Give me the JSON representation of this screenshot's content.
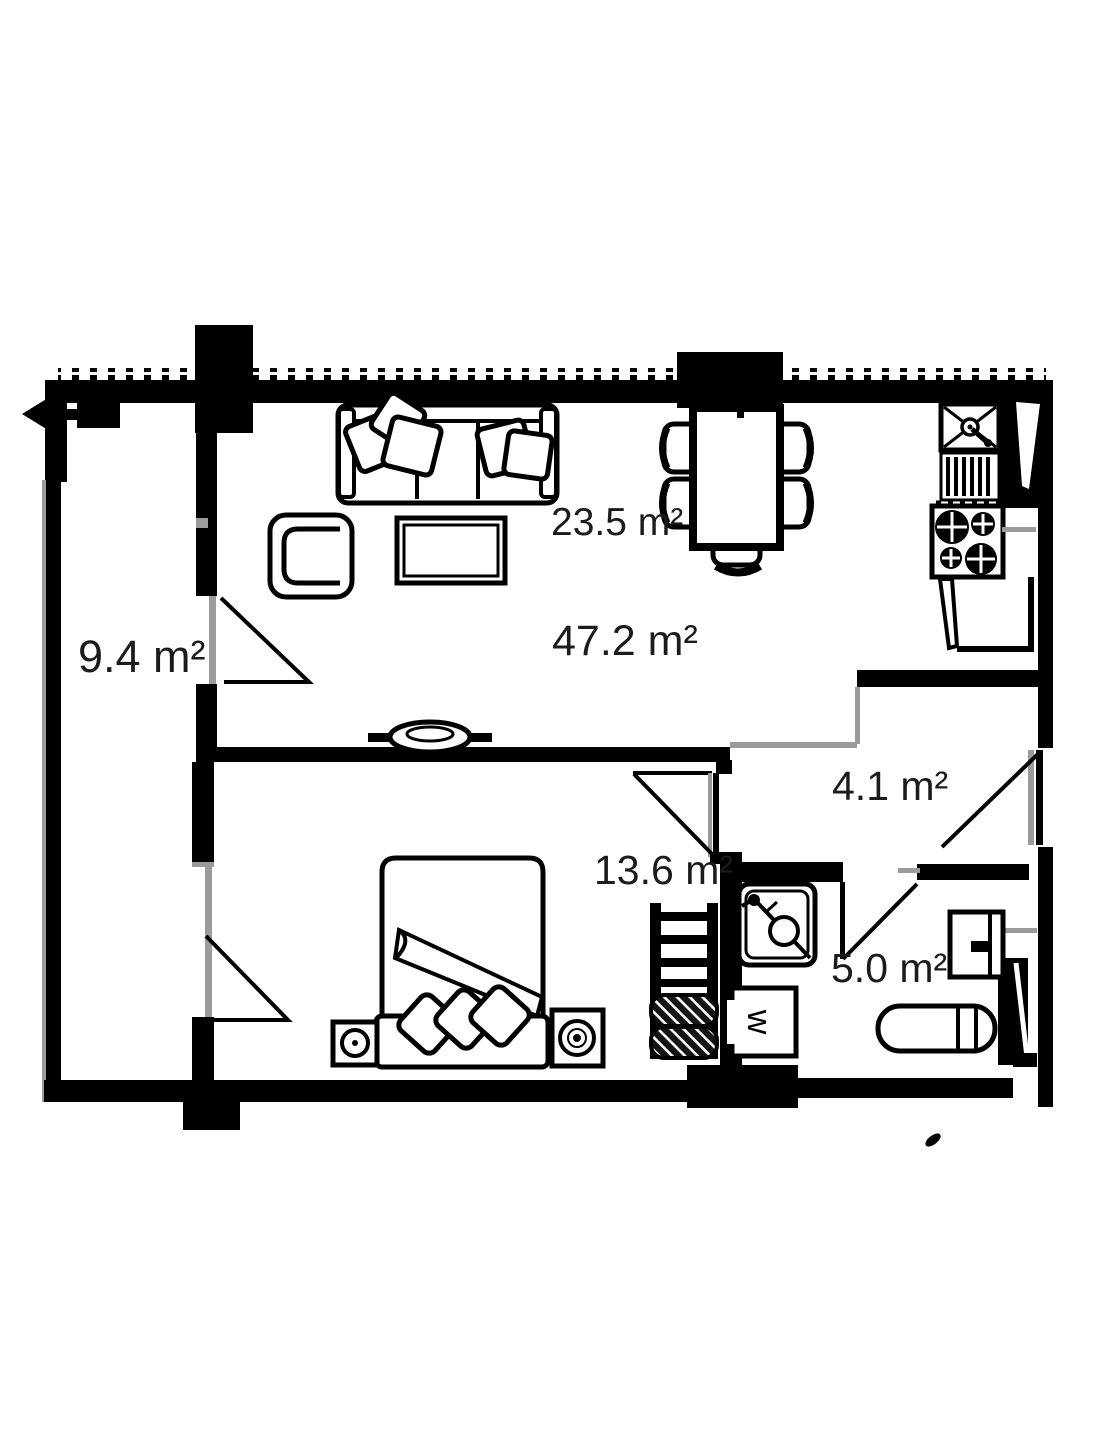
{
  "plan": {
    "type": "apartment-floor-plan",
    "background_color": "#ffffff",
    "wall_color": "#000000",
    "opening_gray": "#9b9b9b",
    "rooms": [
      {
        "id": "corridor",
        "area_label": "9.4 m²"
      },
      {
        "id": "living-dining",
        "area_label": "23.5 m²"
      },
      {
        "id": "apartment-total",
        "area_label": "47.2 m²"
      },
      {
        "id": "bedroom",
        "area_label": "13.6 m²"
      },
      {
        "id": "hallway",
        "area_label": "4.1 m²"
      },
      {
        "id": "bathroom",
        "area_label": "5.0 m²"
      }
    ],
    "annotations": {
      "washer_letter": "w",
      "entry_arrow_direction": "left"
    },
    "furniture": [
      "sofa with pillows",
      "armchair",
      "coffee-table",
      "tv-niche on partition",
      "dining-table with five chairs",
      "kitchen-sink",
      "dish-drainer",
      "stove four burners",
      "kitchen-counter",
      "double-bed with blanket and three pillows",
      "two nightstands with lamps",
      "shelf-rack with rolled bedding",
      "bathroom-sink",
      "washing-machine",
      "toilet",
      "wall-cabinet",
      "ventilation-shafts"
    ]
  }
}
